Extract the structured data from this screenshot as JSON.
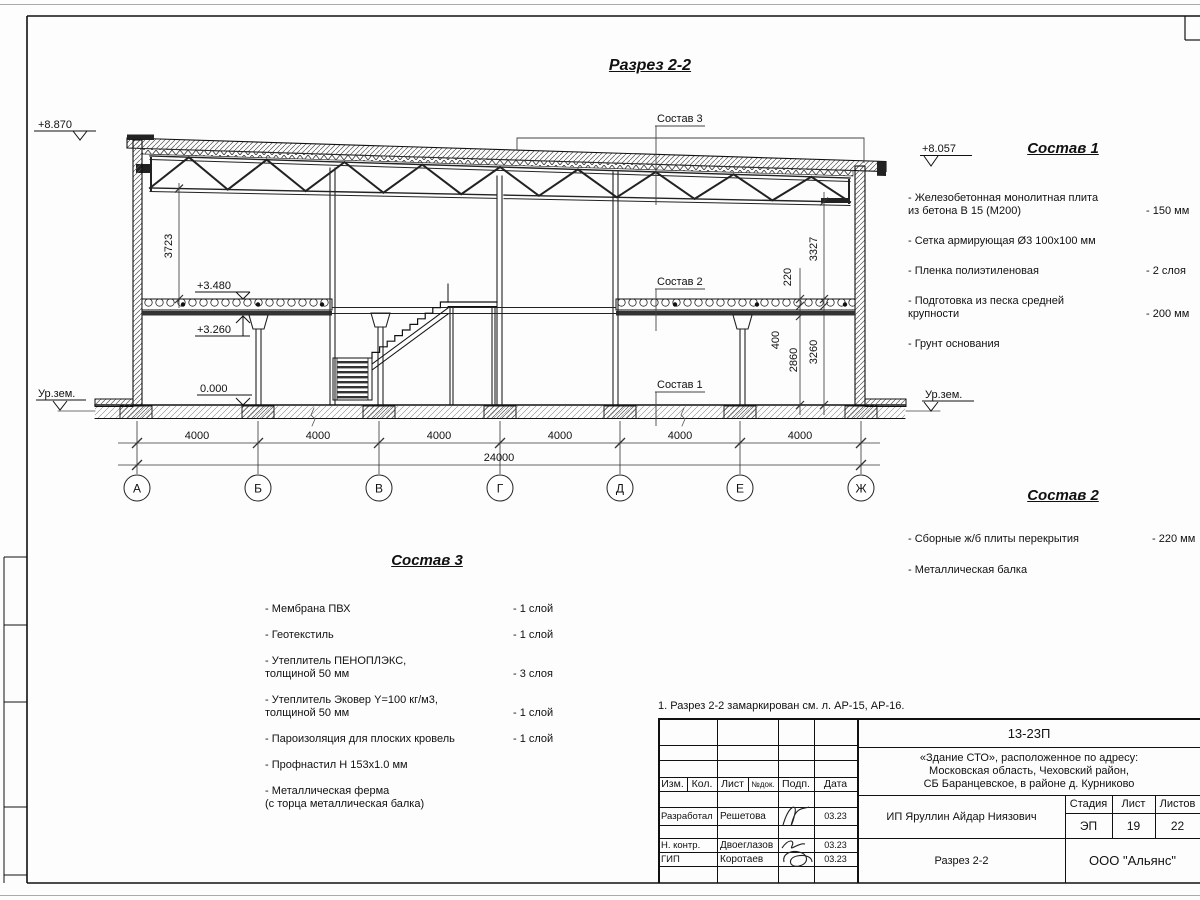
{
  "sheet": {
    "title": "Разрез 2-2",
    "note": "1. Разрез 2-2 замаркирован см. л. АР-15, АР-16."
  },
  "drawing": {
    "axis_labels": [
      "А",
      "Б",
      "В",
      "Г",
      "Д",
      "Е",
      "Ж"
    ],
    "bay_dim": "4000",
    "total_dim": "24000",
    "vdims": {
      "left": "3723",
      "right": "3327",
      "slab": "220",
      "beam": "400",
      "under_beam": "2860",
      "floor_to_slab": "3260"
    },
    "levels": {
      "roof_left": "+8.870",
      "roof_right": "+8.057",
      "slab_top": "+3.480",
      "slab_bottom": "+3.260",
      "floor": "0.000",
      "ground": "Ур.зем."
    },
    "callout_1": "Состав 1",
    "callout_2": "Состав 2",
    "callout_3": "Состав 3"
  },
  "sostav1": {
    "title": "Состав 1",
    "items": [
      {
        "name": "- Железобетонная  монолитная плита\nиз бетона В 15 (М200)",
        "value": "- 150 мм"
      },
      {
        "name": "- Сетка армирующая Ø3 100х100 мм",
        "value": ""
      },
      {
        "name": "- Пленка полиэтиленовая",
        "value": "- 2 слоя"
      },
      {
        "name": "- Подготовка из песка средней\nкрупности",
        "value": "- 200 мм"
      },
      {
        "name": "- Грунт основания",
        "value": ""
      }
    ]
  },
  "sostav2": {
    "title": "Состав 2",
    "items": [
      {
        "name": "- Сборные ж/б плиты перекрытия",
        "value": "- 220 мм"
      },
      {
        "name": "- Металлическая  балка",
        "value": ""
      }
    ]
  },
  "sostav3": {
    "title": "Состав 3",
    "items": [
      {
        "name": "- Мембрана ПВХ",
        "value": "- 1 слой"
      },
      {
        "name": "- Геотекстиль",
        "value": "- 1 слой"
      },
      {
        "name": "- Утеплитель ПЕНОПЛЭКС,\nтолщиной 50 мм",
        "value": "- 3 слоя"
      },
      {
        "name": "- Утеплитель Эковер Y=100 кг/м3,\nтолщиной 50 мм",
        "value": "- 1 слой"
      },
      {
        "name": "- Пароизоляция для плоских кровель",
        "value": "- 1 слой"
      },
      {
        "name": "- Профнастил Н 153х1.0 мм",
        "value": ""
      },
      {
        "name": "- Металлическая ферма\n(с торца металлическая балка)",
        "value": ""
      }
    ]
  },
  "titleblock": {
    "doc_number": "13-23П",
    "project": "«Здание СТО», расположенное по адресу:\nМосковская область, Чеховский район,\nСБ Баранцевское, в районе д. Курниково",
    "client": "ИП Яруллин Айдар Ниязович",
    "drawing_name": "Разрез 2-2",
    "company": "ООО \"Альянс\"",
    "stage_label": "Стадия",
    "sheet_label": "Лист",
    "sheets_label": "Листов",
    "stage": "ЭП",
    "sheet": "19",
    "sheets": "22",
    "columns": [
      "Изм.",
      "Кол.",
      "Лист",
      "№док.",
      "Подп.",
      "Дата"
    ],
    "rows": [
      {
        "role": "Разработал",
        "name": "Решетова",
        "date": "03.23"
      },
      {
        "role": "Н. контр.",
        "name": "Двоеглазов",
        "date": "03.23"
      },
      {
        "role": "ГИП",
        "name": "Коротаев",
        "date": "03.23"
      }
    ]
  }
}
